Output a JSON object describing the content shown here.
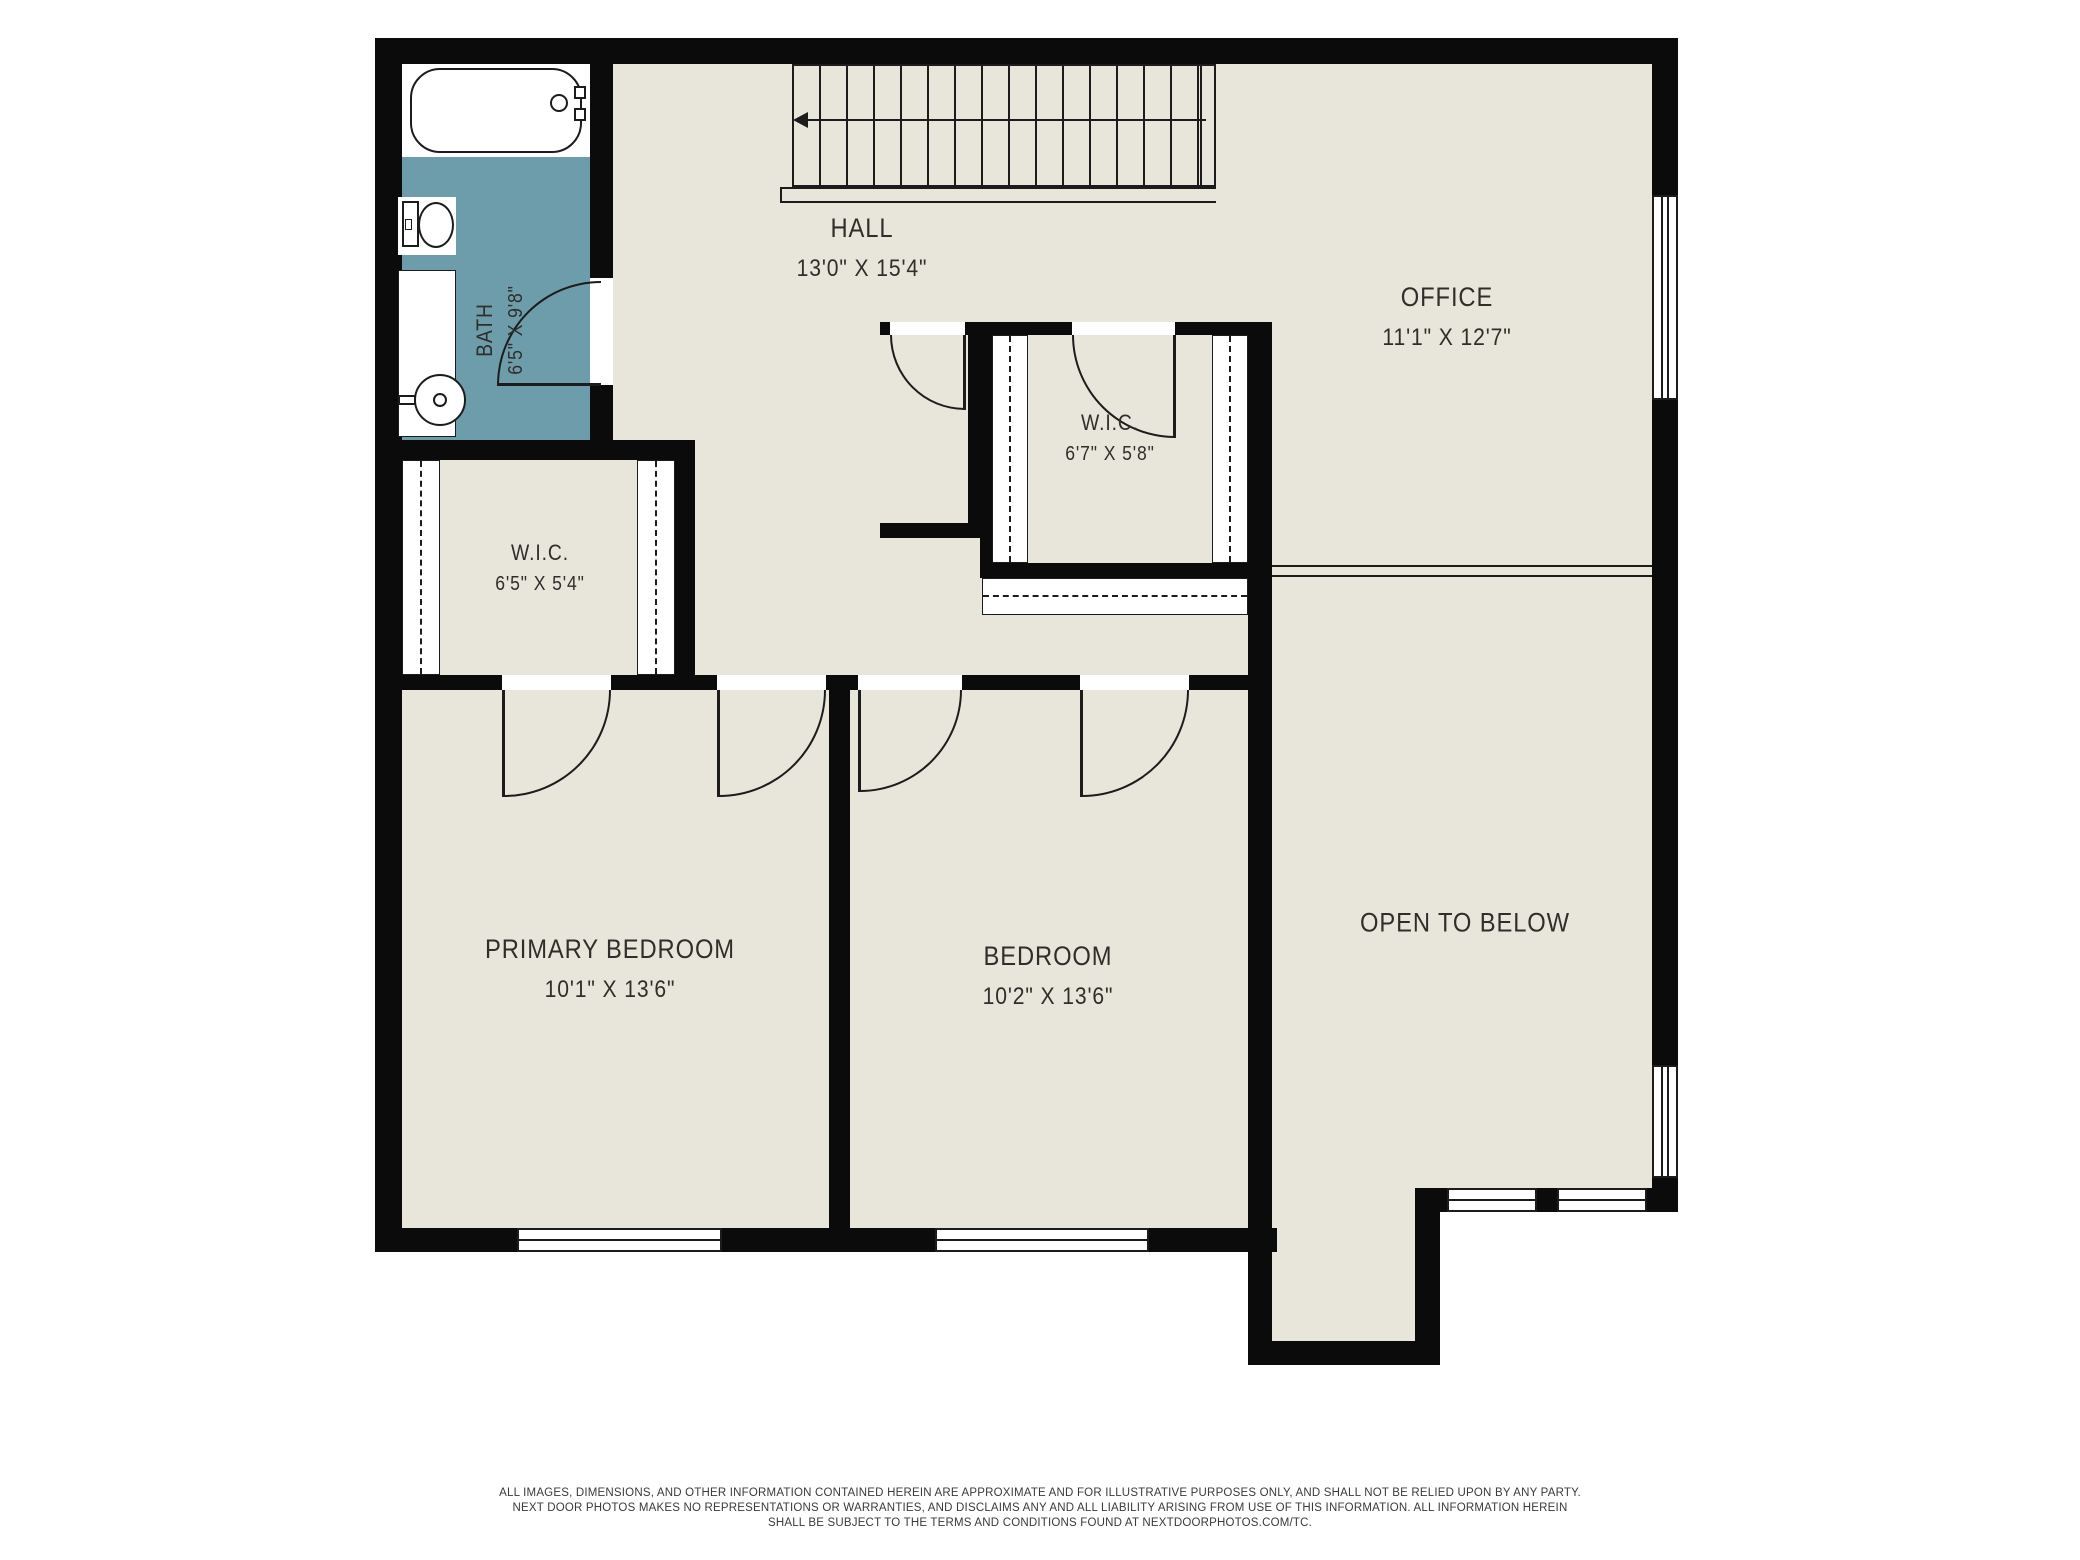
{
  "colors": {
    "floor": "#e8e6da",
    "wall": "#0b0b0b",
    "bath": "#6d9dab",
    "line": "#1c1c1c",
    "text": "#2f2e2a"
  },
  "rooms": {
    "hall": {
      "name": "HALL",
      "dims": "13'0\" X 15'4\""
    },
    "office": {
      "name": "OFFICE",
      "dims": "11'1\" X 12'7\""
    },
    "bath": {
      "name": "BATH",
      "dims": "6'5\" X 9'8\""
    },
    "wic_main": {
      "name": "W.I.C.",
      "dims": "6'7\" X 5'8\""
    },
    "wic_left": {
      "name": "W.I.C.",
      "dims": "6'5\" X 5'4\""
    },
    "primary_bedroom": {
      "name": "PRIMARY BEDROOM",
      "dims": "10'1\" X 13'6\""
    },
    "bedroom": {
      "name": "BEDROOM",
      "dims": "10'2\" X 13'6\""
    },
    "open_below": {
      "name": "OPEN TO BELOW",
      "dims": ""
    }
  },
  "fixtures": {
    "bathtub": "bathtub",
    "toilet": "toilet",
    "sink": "sink",
    "staircase": "staircase"
  },
  "disclaimer": {
    "line1": "ALL IMAGES, DIMENSIONS, AND OTHER INFORMATION CONTAINED HEREIN ARE APPROXIMATE AND FOR ILLUSTRATIVE PURPOSES ONLY, AND SHALL NOT BE RELIED UPON BY ANY PARTY.",
    "line2": "NEXT DOOR PHOTOS MAKES NO REPRESENTATIONS OR WARRANTIES, AND DISCLAIMS ANY AND ALL LIABILITY ARISING FROM USE OF THIS INFORMATION. ALL INFORMATION HEREIN",
    "line3": "SHALL BE SUBJECT TO THE TERMS AND CONDITIONS FOUND AT NEXTDOORPHOTOS.COM/TC."
  }
}
